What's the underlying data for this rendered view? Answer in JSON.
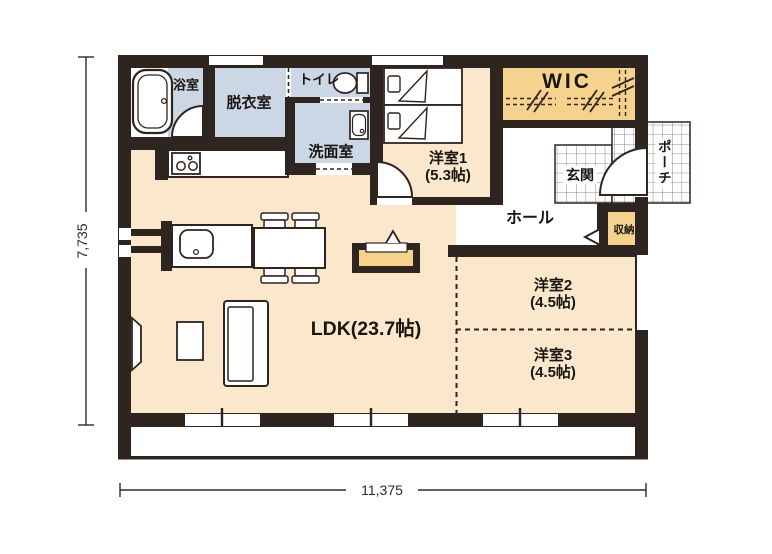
{
  "plan": {
    "dimension_width": "11,375",
    "dimension_height": "7,735",
    "rooms": {
      "bathroom": {
        "label": "浴室"
      },
      "dressing": {
        "label": "脱衣室"
      },
      "toilet": {
        "label": "トイレ"
      },
      "washroom": {
        "label": "洗面室"
      },
      "bedroom1": {
        "label": "洋室1",
        "size": "(5.3帖)"
      },
      "wic": {
        "label": "WIC"
      },
      "entrance": {
        "label": "玄関"
      },
      "porch": {
        "label": "ポーチ"
      },
      "hall": {
        "label": "ホール"
      },
      "storage": {
        "label": "収納"
      },
      "bedroom2": {
        "label": "洋室2",
        "size": "(4.5帖)"
      },
      "bedroom3": {
        "label": "洋室3",
        "size": "(4.5帖)"
      },
      "ldk": {
        "label": "LDK(23.7帖)"
      }
    },
    "colors": {
      "wall": "#2e2420",
      "floor": "#fbe8cc",
      "wet_area": "#ccd7e6",
      "closet": "#f5d28e",
      "tile_line": "#8a8a8a"
    },
    "fixtures": [
      "bathtub",
      "toilet",
      "washbasin",
      "single-bed",
      "kitchen-stove",
      "kitchen-sink",
      "dining-table",
      "dining-chair",
      "sofa",
      "tv",
      "side-table",
      "tv-board",
      "hanger-pipe"
    ]
  }
}
